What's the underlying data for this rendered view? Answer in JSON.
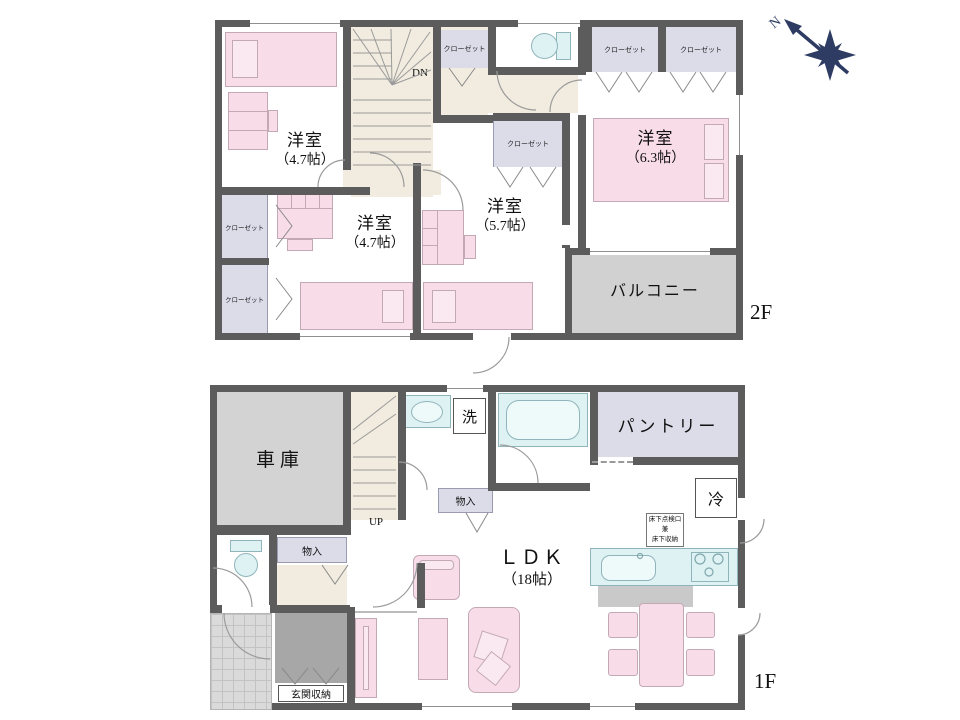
{
  "compass": {
    "north": "N"
  },
  "floor2": {
    "label": "2F",
    "stairs_label": "DN",
    "closet_label": "クローゼット",
    "rooms": {
      "nw": {
        "name": "洋室",
        "size": "（4.7帖）"
      },
      "sw": {
        "name": "洋室",
        "size": "（4.7帖）"
      },
      "center": {
        "name": "洋室",
        "size": "（5.7帖）"
      },
      "east": {
        "name": "洋室",
        "size": "（6.3帖）"
      }
    },
    "balcony_label": "バルコニー"
  },
  "floor1": {
    "label": "1F",
    "stairs_label": "UP",
    "garage_label": "車庫",
    "laundry_label": "洗",
    "pantry_label": "パントリー",
    "fridge_label": "冷",
    "underfloor_lines": [
      "床下点検口",
      "兼",
      "床下収納"
    ],
    "storage_label": "物入",
    "hall_storage_label": "物入",
    "entrance_storage_label": "玄関収納",
    "ldk": {
      "name": "ＬＤＫ",
      "size": "（18帖）"
    }
  },
  "colors": {
    "wall": "#5c5c5c",
    "hallway": "#f1ecdf",
    "closet": "#dcdce9",
    "furniture_pink": "#f8dce8",
    "fixture_cyan": "#def1f3",
    "balcony_gray": "#d1d1d1",
    "entrance_storage_gray": "#a7a7a7",
    "compass_navy": "#2e3c64"
  }
}
